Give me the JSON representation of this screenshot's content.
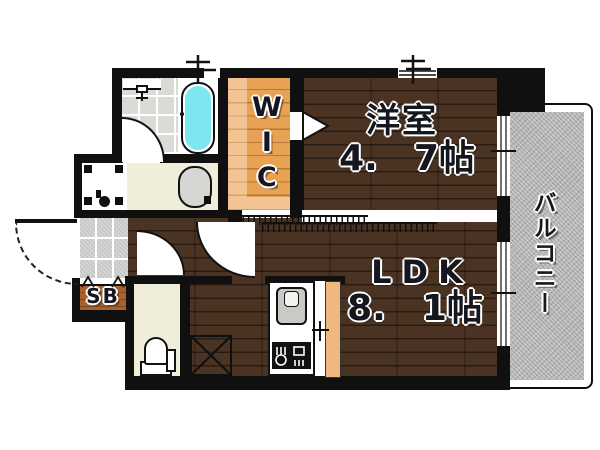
{
  "rooms": {
    "western_room": {
      "label": "洋室",
      "size": "4.　7帖"
    },
    "ldk": {
      "label": "LDK",
      "size": "8.　1帖"
    },
    "wic": {
      "label": "WIC"
    },
    "balcony": {
      "label": "バルコニー"
    },
    "shoe_box": {
      "label": "SB"
    }
  },
  "fixtures": [
    "bathtub",
    "bathroom-vanity",
    "bathroom-door",
    "washing-machine-space",
    "washbasin",
    "toilet",
    "entrance-tile",
    "entrance-door",
    "hall-door",
    "ldk-door",
    "refrigerator-space",
    "kitchen-sink",
    "gas-stove",
    "sliding-door-track",
    "wic-entry-triangle",
    "balcony-window",
    "vent-pipe"
  ],
  "colors": {
    "wall": "#101010",
    "flooring": "#4a3322",
    "wic_wood": "#e8a254",
    "bathtub": "#7ce7f0",
    "balcony": "#b5b5b5",
    "cream_floor": "#f0edda",
    "entrance_tile": "#c7c7c5"
  }
}
